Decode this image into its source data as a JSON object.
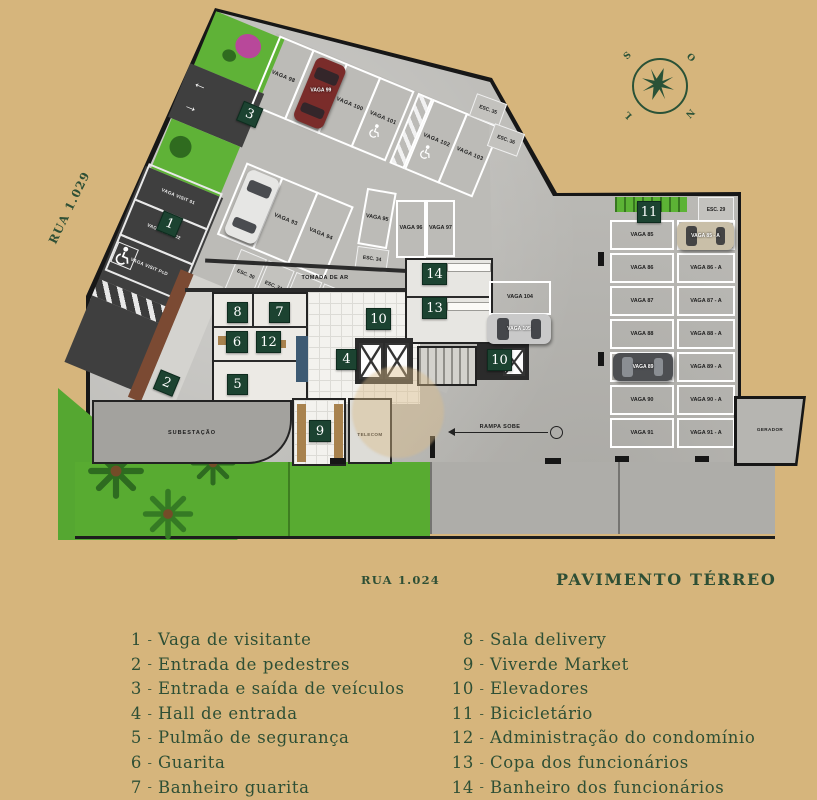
{
  "title": "PAVIMENTO TÉRREO",
  "streets": {
    "left": "RUA 1.029",
    "bottom": "RUA 1.024"
  },
  "compass": {
    "top_left": "S",
    "top_right": "O",
    "bottom_left": "L",
    "bottom_right": "N"
  },
  "legend": {
    "dash": "-",
    "left": [
      {
        "n": "1",
        "t": "Vaga de visitante"
      },
      {
        "n": "2",
        "t": "Entrada de pedestres"
      },
      {
        "n": "3",
        "t": "Entrada e saída de veículos"
      },
      {
        "n": "4",
        "t": "Hall de entrada"
      },
      {
        "n": "5",
        "t": "Pulmão de segurança"
      },
      {
        "n": "6",
        "t": "Guarita"
      },
      {
        "n": "7",
        "t": "Banheiro guarita"
      }
    ],
    "right": [
      {
        "n": "8",
        "t": "Sala delivery"
      },
      {
        "n": "9",
        "t": "Viverde Market"
      },
      {
        "n": "10",
        "t": "Elevadores"
      },
      {
        "n": "11",
        "t": "Bicicletário"
      },
      {
        "n": "12",
        "t": "Administração do condomínio"
      },
      {
        "n": "13",
        "t": "Copa dos funcionários"
      },
      {
        "n": "14",
        "t": "Banheiro dos funcionários"
      }
    ]
  },
  "plan": {
    "markers": {
      "m1": "1",
      "m2": "2",
      "m3": "3",
      "m4": "4",
      "m5": "5",
      "m6": "6",
      "m7": "7",
      "m8": "8",
      "m9": "9",
      "m10": "10",
      "m11": "11",
      "m12": "12",
      "m13": "13",
      "m14": "14"
    },
    "top_row_a": [
      "VAGA 98",
      "",
      "VAGA 100",
      "VAGA 101"
    ],
    "top_row_b": [
      "VAGA 102",
      "VAGA 103"
    ],
    "row2": [
      "",
      "VAGA 93",
      "VAGA 94"
    ],
    "mid_stalls": {
      "v95": "VAGA 95",
      "v96": "VAGA 96",
      "v97": "VAGA 97"
    },
    "visitor_stalls": [
      "VAGA VISIT 01",
      "VAGA VISIT 02",
      "VAGA VISIT PcD"
    ],
    "esc_row": [
      "ESC. 30",
      "ESC. 31",
      "ESC. 32",
      "ESC. 33"
    ],
    "esc": {
      "e29": "ESC. 29",
      "e34": "ESC. 34",
      "e35": "ESC. 35",
      "e36": "ESC. 36"
    },
    "right_grid": [
      "VAGA 85",
      "VAGA 85 - A",
      "VAGA 86",
      "VAGA 86 - A",
      "VAGA 87",
      "VAGA 87 - A",
      "VAGA 88",
      "VAGA 88 - A",
      "VAGA 89",
      "VAGA 89 - A",
      "VAGA 90",
      "VAGA 90 - A",
      "VAGA 91",
      "VAGA 91 - A"
    ],
    "stall_104": "VAGA 104",
    "cars": {
      "red": "VAGA 99",
      "silver": "VAGA 105",
      "tan": "VAGA 85 - A",
      "dark": "VAGA 89"
    },
    "rooms": {
      "subestacao": "SUBESTAÇÃO",
      "telecom": "TELECOM",
      "gerador": "GERADOR"
    },
    "texts": {
      "tomada": "TOMADA DE AR",
      "rampa": "RAMPA SOBE"
    }
  },
  "colors": {
    "background": "#d6b57c",
    "accent_green": "#2e4f35",
    "plaque_green": "#1c4331",
    "grass": "#5fb237",
    "asphalt": "#3f3f3f",
    "concrete": "#bcbbb7"
  }
}
